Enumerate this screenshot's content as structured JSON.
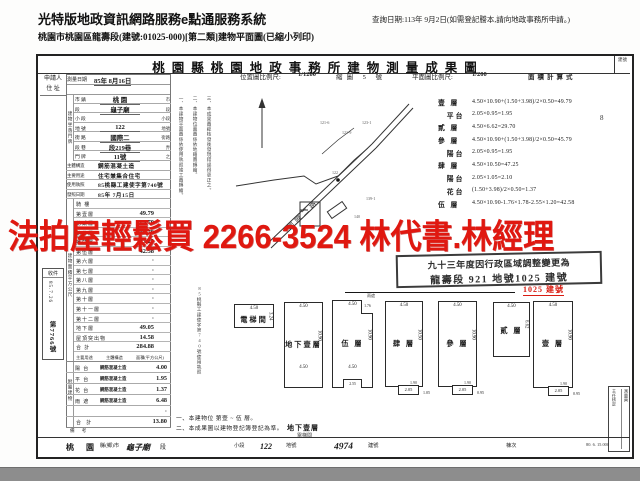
{
  "header": {
    "system_title": "光特版地政資訊網路服務e點通服務系統",
    "query_note": "查詢日期:113年 9月2日(如需登記謄本,請向地政事務所申請。)",
    "subtitle": "桃園市桃園區龍壽段(建號:01025-000)[第二類]建物平面圖(已縮小列印)"
  },
  "doc": {
    "title": "桃園縣桃園地政事務所建物測量成果圖",
    "title_right": "建號",
    "page_mark": "8"
  },
  "scale_bar": {
    "loc_label": "位置圖比例尺:",
    "loc_scale": "1/1200",
    "sheet": "縮圖 5 號",
    "plan_label": "平面圖比例尺:",
    "plan_scale": "1/200",
    "formula_header": "面積計算式"
  },
  "left_table": {
    "applicant_label": "申請人",
    "address_label": "住 址",
    "survey_date_label": "測量日期",
    "survey_date": "85年 8月16日",
    "coord_group": "建物坐落門牌",
    "coord_rows": [
      {
        "label": "市 鎮",
        "value": "桃 園",
        "suffix": "市"
      },
      {
        "label": "段",
        "value": "龜子廟",
        "suffix": "段"
      },
      {
        "label": "小 段",
        "value": "",
        "suffix": "小段"
      },
      {
        "label": "地 號",
        "value": "122",
        "suffix": "地號"
      },
      {
        "label": "街 路",
        "value": "國際二",
        "suffix": "街路"
      },
      {
        "label": "段 巷",
        "value": "段219巷",
        "suffix": "弄"
      },
      {
        "label": "門 牌",
        "value": "11號",
        "suffix": "之"
      }
    ],
    "info_rows": [
      {
        "label": "主體構造",
        "value": "鋼筋混凝土造"
      },
      {
        "label": "主要用途",
        "value": "住宅兼集合住宅"
      },
      {
        "label": "使用執照",
        "value": "85桃縣工建使字第740號"
      },
      {
        "label": "發照日期",
        "value": "85年 7月15日"
      }
    ],
    "area_group": "建物面積平方公尺",
    "area_rows": [
      {
        "label": "騎 樓",
        "value": ""
      },
      {
        "label": "第壹層",
        "value": "49.79"
      },
      {
        "label": "第貳層",
        "value": "29.70"
      },
      {
        "label": "第參層",
        "value": "45.79"
      },
      {
        "label": "第肆層",
        "value": "47.25"
      },
      {
        "label": "第伍層",
        "value": "42.58"
      },
      {
        "label": "第六層",
        "value": "·"
      },
      {
        "label": "第七層",
        "value": "·"
      },
      {
        "label": "第八層",
        "value": "·"
      },
      {
        "label": "第九層",
        "value": "·"
      },
      {
        "label": "第十層",
        "value": "·"
      },
      {
        "label": "第十一層",
        "value": "·"
      },
      {
        "label": "第十二層",
        "value": "·"
      },
      {
        "label": "地下層",
        "value": "49.05"
      },
      {
        "label": "屋頂突出物",
        "value": "14.58"
      },
      {
        "label": "合 計",
        "value": "284.88"
      }
    ],
    "attached_group": "附屬建物",
    "attached_headers": {
      "use": "主要用途",
      "structure": "主體構造",
      "area": "面積(平方公尺)"
    },
    "attached_rows": [
      {
        "use": "陽 台",
        "structure": "鋼筋混凝土造",
        "area": "4.00"
      },
      {
        "use": "平 台",
        "structure": "鋼筋混凝土造",
        "area": "1.95"
      },
      {
        "use": "花 台",
        "structure": "鋼筋混凝土造",
        "area": "1.37"
      },
      {
        "use": "雨 遮",
        "structure": "鋼筋混凝土造",
        "area": "6.48"
      },
      {
        "use": "",
        "structure": "",
        "area": "·"
      }
    ],
    "attached_total_label": "合 計",
    "attached_total": "13.80",
    "remark_label": "備 考"
  },
  "intake": {
    "title": "收件",
    "date": "85.7.26",
    "number": "第7766號"
  },
  "vertical_notes": [
    {
      "text": "一、本建物平面圖係依使用執照竣工圖轉繪。",
      "x": 178,
      "y": 96,
      "h": 112
    },
    {
      "text": "二、本建物位置圖係依地籍圖轉繪。",
      "x": 192,
      "y": 96,
      "h": 100
    },
    {
      "text": "三、本成果圖經核發後發現錯誤得更正之。",
      "x": 206,
      "y": 96,
      "h": 112
    },
    {
      "text": "85桃縣工建使字第740號使用執照",
      "x": 196,
      "y": 286,
      "h": 96
    }
  ],
  "formulas": {
    "rows": [
      {
        "label": "壹 層",
        "expr": "4.50×10.90+(1.50+3.98)/2×0.50=49.79"
      },
      {
        "label": "　平台",
        "expr": "2.05×0.95=1.95"
      },
      {
        "label": "貳 層",
        "expr": "4.50×6.62=29.70"
      },
      {
        "label": "參 層",
        "expr": "4.50×10.90+(1.50+3.98)/2×0.50=45.79"
      },
      {
        "label": "　陽台",
        "expr": "2.05×0.95=1.95"
      },
      {
        "label": "肆 層",
        "expr": "4.50×10.50=47.25"
      },
      {
        "label": "　陽台",
        "expr": "2.05×1.05=2.10"
      },
      {
        "label": "　花台",
        "expr": "(1.50+3.98)/2×0.50=1.37"
      },
      {
        "label": "伍 層",
        "expr": "4.50×10.90-1.76×1.78-2.55×1.20=42.58"
      }
    ]
  },
  "watermark": {
    "text": "法拍屋輕鬆買  2266-3524  林代書.林經理",
    "color": "#e01810"
  },
  "stamp": {
    "line1": "九十三年度因行政區域調整變更為",
    "line2": "龍壽段 921 地號1025 建號",
    "echo": "1025 建號"
  },
  "location_map": {
    "road_label": "國際二路",
    "lots": [
      "121-6",
      "121-9",
      "123-1",
      "122",
      "140",
      "139-1"
    ]
  },
  "floor_plans": {
    "boxes": [
      {
        "x": 234,
        "y": 304,
        "w": 40,
        "h": 24,
        "top": "4.50",
        "side": "3.24",
        "label": "電梯間"
      },
      {
        "x": 284,
        "y": 302,
        "w": 39,
        "h": 86,
        "top": "4.50",
        "side": "10.90",
        "label": "地下壹層",
        "inner": "4.50"
      },
      {
        "x": 332,
        "y": 300,
        "w": 41,
        "h": 88,
        "top": "4.50",
        "side": "10.90",
        "label": "伍 層",
        "inner": "4.50",
        "notch": "1.76",
        "notch_cap": "雨遮",
        "bnotch": "2.55"
      },
      {
        "x": 385,
        "y": 301,
        "w": 38,
        "h": 86,
        "top": "4.50",
        "side": "10.50",
        "label": "肆 層",
        "bump_w": "2.05",
        "bump_h": "1.05",
        "bump_label": "1.90"
      },
      {
        "x": 438,
        "y": 301,
        "w": 39,
        "h": 86,
        "top": "4.50",
        "side": "10.90",
        "label": "參 層",
        "bump_w": "2.05",
        "bump_h": "0.95",
        "bump_label": "1.90"
      },
      {
        "x": 493,
        "y": 302,
        "w": 37,
        "h": 55,
        "top": "4.50",
        "side": "6.62",
        "label": "貳 層"
      },
      {
        "x": 533,
        "y": 301,
        "w": 40,
        "h": 87,
        "top": "4.50",
        "side": "10.90",
        "label": "壹 層",
        "bump_w": "2.05",
        "bump_h": "0.95",
        "bump_label": "1.90"
      }
    ],
    "caption1": "地下壹層",
    "caption2": "電梯間",
    "note1": "一、本建物位 第壹 ~ 伍 層。",
    "note2": "二、本成果圖以建物登記簿登記為準。"
  },
  "sign_box": {
    "col1": "主任核定",
    "col2": "測量員"
  },
  "bottom_strip": {
    "f1": "桃 園",
    "f2": "縣(鄉)市",
    "f3": "龜子廟",
    "f4": "段",
    "f5": "小段",
    "f6": "122",
    "f7": "地號",
    "f8": "4974",
    "f9": "建號",
    "f10": "棟次",
    "form_no": "80. 6. 15.000"
  }
}
